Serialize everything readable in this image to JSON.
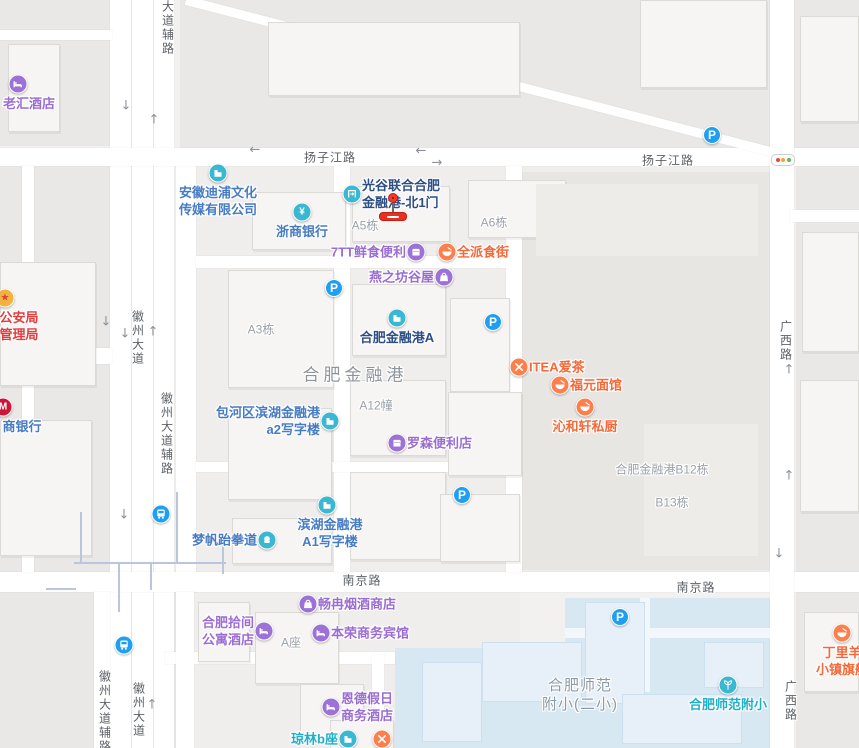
{
  "app": {
    "title": "地图视图"
  },
  "colors": {
    "poi_teal_icon": "#3ab8d2",
    "poi_purple": "#9a6dd2",
    "poi_orange": "#f4693a",
    "poi_blue_text": "#477cc3",
    "poi_navy_text": "#2d4e85",
    "poi_teal_text": "#1fb0c8",
    "poi_red_text": "#e23c3c",
    "parking_blue": "#1e9ff2",
    "road_label_gray": "#5d6166",
    "area_label_gray": "#9ba1a8",
    "school_area_fill": "#d8e8f3",
    "marker_red": "#e8301f"
  },
  "road_labels": [
    {
      "text": "扬子江路",
      "x": 330,
      "y": 157,
      "vertical": false
    },
    {
      "text": "扬子江路",
      "x": 668,
      "y": 160,
      "vertical": false
    },
    {
      "text": "南京路",
      "x": 362,
      "y": 580,
      "vertical": false
    },
    {
      "text": "南京路",
      "x": 696,
      "y": 587,
      "vertical": false
    },
    {
      "text": "大道辅路",
      "x": 168,
      "y": 28,
      "vertical": true
    },
    {
      "text": "徽州大道",
      "x": 138,
      "y": 338,
      "vertical": true
    },
    {
      "text": "徽州大道辅路",
      "x": 167,
      "y": 434,
      "vertical": true
    },
    {
      "text": "徽州大道辅路",
      "x": 105,
      "y": 712,
      "vertical": true
    },
    {
      "text": "徽州大道",
      "x": 139,
      "y": 710,
      "vertical": true
    },
    {
      "text": "广西路",
      "x": 786,
      "y": 341,
      "vertical": true
    },
    {
      "text": "广西路",
      "x": 791,
      "y": 701,
      "vertical": true
    }
  ],
  "area_labels": [
    {
      "lines": [
        "A5栋"
      ],
      "x": 365,
      "y": 226,
      "cls": ""
    },
    {
      "lines": [
        "A6栋"
      ],
      "x": 494,
      "y": 223,
      "cls": ""
    },
    {
      "lines": [
        "A3栋"
      ],
      "x": 261,
      "y": 330,
      "cls": ""
    },
    {
      "lines": [
        "A12幢"
      ],
      "x": 376,
      "y": 406,
      "cls": ""
    },
    {
      "lines": [
        "合肥金融港"
      ],
      "x": 355,
      "y": 375,
      "cls": "big"
    },
    {
      "lines": [
        "合肥金融港B12栋"
      ],
      "x": 662,
      "y": 470,
      "cls": ""
    },
    {
      "lines": [
        "B13栋"
      ],
      "x": 672,
      "y": 503,
      "cls": ""
    },
    {
      "lines": [
        "A座"
      ],
      "x": 291,
      "y": 643,
      "cls": ""
    },
    {
      "lines": [
        "合肥师范",
        "附小(二小)"
      ],
      "x": 580,
      "y": 695,
      "cls": "school-name"
    }
  ],
  "pois": [
    {
      "id": "laohui-hotel",
      "x": 18,
      "y": 84,
      "icon": "hotel",
      "icon_bg": "purple",
      "text_color": "purple",
      "side": "below",
      "ldx": 11,
      "lines": [
        "老汇酒店"
      ]
    },
    {
      "id": "anhui-dipu-media",
      "x": 218,
      "y": 173,
      "icon": "company",
      "icon_bg": "teal",
      "text_color": "blue",
      "side": "below",
      "ldx": 0,
      "lines": [
        "安徽迪浦文化",
        "传媒有限公司"
      ]
    },
    {
      "id": "zheshang-bank",
      "x": 302,
      "y": 212,
      "icon": "bank",
      "icon_bg": "teal",
      "text_color": "blue",
      "side": "below",
      "ldx": 0,
      "lines": [
        "浙商银行"
      ]
    },
    {
      "id": "guanggu-north-gate-1",
      "x": 352,
      "y": 194,
      "icon": "gate",
      "icon_bg": "teal",
      "text_color": "navy",
      "side": "right",
      "ldx": 0,
      "lines": [
        "光谷联合合肥",
        "金融港-北1门"
      ]
    },
    {
      "id": "7tt-convenience",
      "x": 416,
      "y": 252,
      "icon": "shop",
      "icon_bg": "purple",
      "text_color": "purple",
      "side": "left",
      "ldx": 0,
      "lines": [
        "7TT鲜食便利"
      ]
    },
    {
      "id": "quanpai-food-street",
      "x": 447,
      "y": 252,
      "icon": "bowl",
      "icon_bg": "orange",
      "text_color": "orange",
      "side": "right",
      "ldx": 0,
      "lines": [
        "全派食街"
      ]
    },
    {
      "id": "yanzhifang-guwu",
      "x": 444,
      "y": 277,
      "icon": "bag",
      "icon_bg": "purple",
      "text_color": "purple",
      "side": "left",
      "ldx": 0,
      "lines": [
        "燕之坊谷屋"
      ]
    },
    {
      "id": "hefei-financial-port-a",
      "x": 397,
      "y": 318,
      "icon": "company",
      "icon_bg": "teal",
      "text_color": "navy",
      "side": "below",
      "ldx": 0,
      "lines": [
        "合肥金融港A"
      ]
    },
    {
      "id": "itea-aicha",
      "x": 519,
      "y": 367,
      "icon": "utensils",
      "icon_bg": "orange",
      "text_color": "orange",
      "side": "right",
      "ldx": 0,
      "lines": [
        "ITEA爱茶"
      ]
    },
    {
      "id": "fuyuan-noodles",
      "x": 560,
      "y": 385,
      "icon": "bowl",
      "icon_bg": "orange",
      "text_color": "orange",
      "side": "right",
      "ldx": 0,
      "lines": [
        "福元面馆"
      ]
    },
    {
      "id": "qinhexuan-kitchen",
      "x": 585,
      "y": 407,
      "icon": "bowl",
      "icon_bg": "orange",
      "text_color": "orange",
      "side": "below",
      "ldx": 0,
      "lines": [
        "沁和轩私厨"
      ]
    },
    {
      "id": "baohe-binhu-a2-office",
      "x": 330,
      "y": 421,
      "icon": "company",
      "icon_bg": "teal",
      "text_color": "blue",
      "side": "left",
      "ldx": 0,
      "lines": [
        "包河区滨湖金融港",
        "a2写字楼"
      ]
    },
    {
      "id": "lawson-convenience",
      "x": 397,
      "y": 443,
      "icon": "shop",
      "icon_bg": "purple",
      "text_color": "purple",
      "side": "right",
      "ldx": 0,
      "lines": [
        "罗森便利店"
      ]
    },
    {
      "id": "binhu-a1-office",
      "x": 327,
      "y": 505,
      "icon": "company",
      "icon_bg": "teal",
      "text_color": "blue",
      "side": "below",
      "ldx": 3,
      "lines": [
        "滨湖金融港",
        "A1写字楼"
      ]
    },
    {
      "id": "mengfan-taekwondo",
      "x": 267,
      "y": 540,
      "icon": "fist",
      "icon_bg": "teal",
      "text_color": "blue",
      "side": "left",
      "ldx": 0,
      "lines": [
        "梦帆跆拳道"
      ]
    },
    {
      "id": "changran-tobacco-shop",
      "x": 308,
      "y": 604,
      "icon": "bag",
      "icon_bg": "purple",
      "text_color": "purple",
      "side": "right",
      "ldx": 0,
      "lines": [
        "畅冉烟酒商店"
      ]
    },
    {
      "id": "hefei-shijian-apartment-hotel",
      "x": 264,
      "y": 631,
      "icon": "hotel",
      "icon_bg": "purple",
      "text_color": "purple",
      "side": "left",
      "ldx": 0,
      "lines": [
        "合肥拾间",
        "公寓酒店"
      ]
    },
    {
      "id": "benrong-business-hotel",
      "x": 321,
      "y": 633,
      "icon": "hotel",
      "icon_bg": "purple",
      "text_color": "purple",
      "side": "right",
      "ldx": 0,
      "lines": [
        "本荣商务宾馆"
      ]
    },
    {
      "id": "ende-holiday-hotel",
      "x": 331,
      "y": 707,
      "icon": "hotel",
      "icon_bg": "purple",
      "text_color": "purple",
      "side": "right",
      "ldx": 0,
      "lines": [
        "恩德假日",
        "商务酒店"
      ]
    },
    {
      "id": "qionglin-b-block",
      "x": 348,
      "y": 739,
      "icon": "company",
      "icon_bg": "teal",
      "text_color": "teal",
      "side": "left",
      "ldx": 0,
      "lines": [
        "琼林b座"
      ]
    },
    {
      "id": "restaurant-unlabeled",
      "x": 382,
      "y": 739,
      "icon": "utensils",
      "icon_bg": "orange",
      "text_color": "orange",
      "side": "right",
      "ldx": 0,
      "lines": []
    },
    {
      "id": "hefei-shifan-fuxiao",
      "x": 728,
      "y": 685,
      "icon": "tree",
      "icon_bg": "teal",
      "text_color": "teal",
      "side": "below",
      "ldx": 0,
      "lines": [
        "合肥师范附小"
      ]
    },
    {
      "id": "dingliyang-flagship",
      "x": 842,
      "y": 633,
      "icon": "bowl",
      "icon_bg": "orange",
      "text_color": "orange",
      "side": "below",
      "ldx": 0,
      "lines": [
        "丁里羊",
        "小镇旗舰"
      ]
    },
    {
      "id": "public-security-bureau",
      "x": 5,
      "y": 298,
      "icon": "emblem",
      "icon_bg": "gold",
      "text_color": "red",
      "side": "below",
      "ldx": 14,
      "lines": [
        "公安局",
        "管理局"
      ]
    },
    {
      "id": "merchants-bank",
      "x": 3,
      "y": 407,
      "icon": "cmb",
      "icon_bg": "cmbred",
      "text_color": "blue",
      "side": "below",
      "ldx": 19,
      "lines": [
        "商银行"
      ]
    }
  ],
  "parking_positions": [
    {
      "x": 334,
      "y": 288
    },
    {
      "x": 712,
      "y": 135
    },
    {
      "x": 493,
      "y": 322
    },
    {
      "x": 462,
      "y": 495
    },
    {
      "x": 620,
      "y": 617
    }
  ],
  "parking_glyph": "P",
  "transit_positions": [
    {
      "x": 161,
      "y": 514
    },
    {
      "x": 124,
      "y": 645
    }
  ],
  "arrows": [
    {
      "x": 126,
      "y": 106,
      "dir": "down"
    },
    {
      "x": 154,
      "y": 120,
      "dir": "up"
    },
    {
      "x": 255,
      "y": 150,
      "dir": "left"
    },
    {
      "x": 421,
      "y": 151,
      "dir": "left"
    },
    {
      "x": 437,
      "y": 163,
      "dir": "right"
    },
    {
      "x": 106,
      "y": 322,
      "dir": "down"
    },
    {
      "x": 125,
      "y": 334,
      "dir": "down"
    },
    {
      "x": 153,
      "y": 332,
      "dir": "up"
    },
    {
      "x": 124,
      "y": 515,
      "dir": "down"
    },
    {
      "x": 152,
      "y": 705,
      "dir": "up"
    },
    {
      "x": 789,
      "y": 370,
      "dir": "up"
    },
    {
      "x": 789,
      "y": 476,
      "dir": "up"
    },
    {
      "x": 779,
      "y": 554,
      "dir": "down"
    }
  ],
  "traffic_light": {
    "x": 783,
    "y": 160,
    "dot_colors": [
      "#e5493d",
      "#f5a623",
      "#5cb85c"
    ]
  },
  "destination_marker": {
    "x": 393,
    "y": 198
  }
}
